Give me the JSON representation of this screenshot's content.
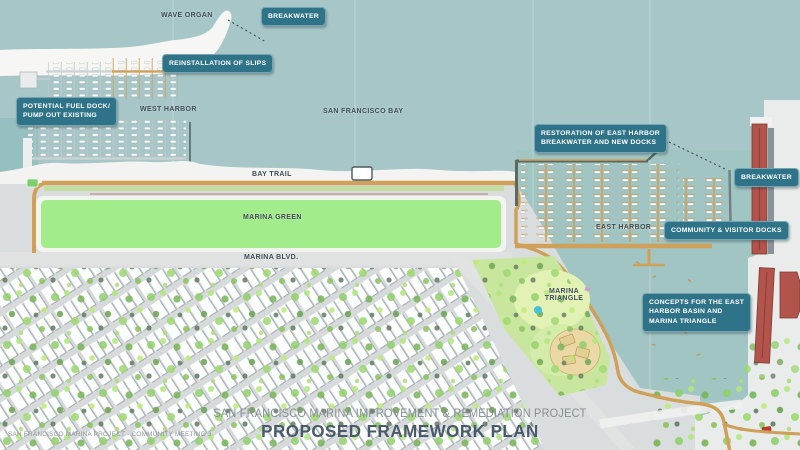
{
  "poster": {
    "project_title": "SAN FRANCISCO MARINA IMPROVEMENT & REMEDIATION PROJECT",
    "plan_title": "PROPOSED FRAMEWORK PLAN",
    "footnote": "SAN FRANCISCO MARINA PROJECT - COMMUNITY MEETING 3"
  },
  "labels": {
    "wave_organ": "WAVE ORGAN",
    "west_harbor": "WEST HARBOR",
    "san_francisco_bay": "SAN FRANCISCO BAY",
    "bay_trail": "BAY TRAIL",
    "marina_green": "MARINA GREEN",
    "marina_blvd": "MARINA BLVD.",
    "east_harbor": "EAST HARBOR",
    "marina_triangle": "MARINA\nTRIANGLE"
  },
  "callouts": {
    "breakwater_west": "BREAKWATER",
    "reinstallation_of_slips": "REINSTALLATION OF SLIPS",
    "potential_fuel_dock": "POTENTIAL FUEL DOCK/\nPUMP OUT EXISTING",
    "restoration_east_harbor": "RESTORATION OF EAST HARBOR\nBREAKWATER AND NEW DOCKS",
    "breakwater_east": "BREAKWATER",
    "community_visitor_docks": "COMMUNITY & VISITOR DOCKS",
    "concepts_east_harbor": "CONCEPTS FOR THE EAST\nHARBOR BASIN AND\nMARINA TRIANGLE"
  },
  "colors": {
    "bay_water": "#a6c6c7",
    "land_gray": "#dadddd",
    "marina_green_fill": "#a3ec8b",
    "bay_trail_tan": "#cfa058",
    "callout_teal": "#2f7389",
    "map_label_ink": "#3d4c54",
    "pier_red": "#b2544b",
    "plan_title_ink": "#47596b"
  }
}
